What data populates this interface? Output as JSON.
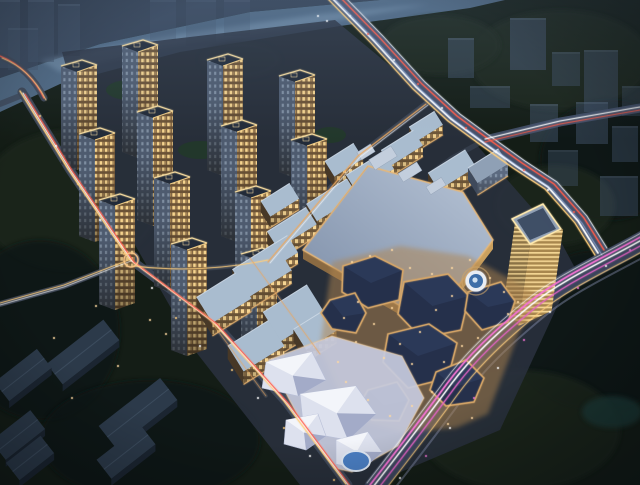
{
  "image": {
    "alt": "Aerial night rendering of a mixed-use development: lit residential towers by a river, a large flat-roofed shopping mall, a golden office tower, faceted commercial pavilions around a glowing plaza, a bright festival square with white tents and a blue pool, roads with coloured light trails and dark woodland around the site"
  },
  "palette": {
    "base": "#141d16",
    "farShore": "#36455a",
    "river": "#4e6781",
    "riverHi": "#7e9ab4",
    "treeA": "#1a271e",
    "treeB": "#0f1812",
    "treeC": "#223829",
    "pond": "#1d3b38",
    "ghost": "#42536a",
    "pad": "#2a3140",
    "asphalt": "#3d4758",
    "asphaltMain": "#475470",
    "asphaltCurve": "#3b455c",
    "trailWhite": "#ffffff",
    "trailWarm": "#ffcf7e",
    "trailRed": "#ff5d49",
    "trailMagenta": "#f273d2",
    "trailMagenta2": "#e263c4",
    "trailBlue": "#a8c4ff",
    "trailTail": "#8891b0",
    "towerRoof": "#222b39",
    "towerWarmBase": "#6b5236",
    "towerWin": "#f5d38e",
    "towerWin2": "#caa266",
    "towerCoolBase": "#4e5b6f",
    "towerCoolWin": "#aebfd2",
    "crown": "#ffe3a4",
    "mallLight": "#b7c4d6",
    "mallDark": "#7b8ca6",
    "mallEdge": "#e8b878",
    "mallFacade": "#caa05e",
    "mallFacadeDark": "#8a6a42",
    "mallBump": "#c3cedd",
    "midRoof": "#a9bccf",
    "midRoofEdge": "#cdd9e6",
    "midFacade": "#6e5638",
    "midWin": "#f6d592",
    "midSide": "#473827",
    "midCoolFacade": "#5c6a80",
    "goldFace1": "#a8874e",
    "goldFace2": "#8f7648",
    "goldLine": "#f2d492",
    "goldRoof": "#93a4ba",
    "goldEdge": "#ffe9ae",
    "pavRoof": "#25304b",
    "pavFacet": "#2e3c5c",
    "pavEdge": "#d9a868",
    "walkway": "#b08550",
    "dotWarm": "#ffd9a2",
    "slabRoof": "#2c3a4a",
    "slabSide": "#1b2531",
    "slabRidge": "#3c4c5e",
    "festGround": "#c6cade",
    "tent": "#dde1ee",
    "tentHi": "#f3f5fa",
    "tentShade": "#a3abc8",
    "pool": "#4a7ec2",
    "poolRim": "#dfe8f4",
    "fountainRing": "#e9edf3",
    "fountainWater": "#3e6ea8",
    "vignette": "rgba(2,6,12,0.42)"
  },
  "scene": {
    "river": [
      [
        0,
        78
      ],
      [
        100,
        44
      ],
      [
        250,
        12
      ],
      [
        380,
        0
      ],
      [
        505,
        0
      ],
      [
        470,
        8
      ],
      [
        340,
        26
      ],
      [
        180,
        52
      ],
      [
        60,
        84
      ],
      [
        0,
        112
      ]
    ],
    "riverHighlight": [
      [
        40,
        60
      ],
      [
        180,
        34
      ],
      [
        320,
        14
      ],
      [
        430,
        4
      ],
      [
        330,
        22
      ],
      [
        160,
        48
      ],
      [
        60,
        72
      ]
    ],
    "farShore": [
      [
        0,
        0
      ],
      [
        380,
        0
      ],
      [
        250,
        12
      ],
      [
        100,
        44
      ],
      [
        0,
        78
      ]
    ],
    "sitePad": [
      [
        62,
        52
      ],
      [
        335,
        20
      ],
      [
        455,
        120
      ],
      [
        560,
        240
      ],
      [
        575,
        268
      ],
      [
        500,
        430
      ],
      [
        370,
        485
      ],
      [
        300,
        485
      ],
      [
        196,
        352
      ],
      [
        98,
        180
      ]
    ],
    "treeBlobs": [
      [
        70,
        200,
        90,
        70,
        "treeA"
      ],
      [
        40,
        330,
        80,
        90,
        "treeB"
      ],
      [
        150,
        440,
        110,
        60,
        "treeB"
      ],
      [
        560,
        60,
        90,
        50,
        "treeA"
      ],
      [
        610,
        160,
        70,
        60,
        "treeB"
      ],
      [
        555,
        205,
        60,
        40,
        "treeA"
      ],
      [
        600,
        330,
        90,
        80,
        "treeB"
      ],
      [
        520,
        430,
        100,
        60,
        "treeA"
      ],
      [
        440,
        45,
        60,
        30,
        "treeA"
      ],
      [
        240,
        60,
        40,
        18,
        "treeA"
      ],
      [
        612,
        412,
        30,
        16,
        "pond"
      ]
    ],
    "greenPockets": [
      [
        130,
        90,
        24,
        10
      ],
      [
        200,
        150,
        22,
        9
      ],
      [
        260,
        220,
        20,
        8
      ],
      [
        330,
        135,
        16,
        8
      ],
      [
        300,
        170,
        12,
        6
      ],
      [
        255,
        230,
        12,
        6
      ]
    ],
    "ghostBuildings": [
      [
        448,
        38,
        26,
        40,
        0.5
      ],
      [
        510,
        18,
        36,
        52,
        0.55
      ],
      [
        552,
        52,
        28,
        34,
        0.45
      ],
      [
        584,
        50,
        34,
        62,
        0.5
      ],
      [
        470,
        86,
        40,
        22,
        0.45
      ],
      [
        530,
        104,
        28,
        38,
        0.5
      ],
      [
        576,
        102,
        32,
        42,
        0.5
      ],
      [
        612,
        126,
        26,
        36,
        0.45
      ],
      [
        548,
        150,
        30,
        36,
        0.4
      ],
      [
        600,
        176,
        38,
        40,
        0.45
      ],
      [
        622,
        86,
        18,
        30,
        0.4
      ],
      [
        28,
        0,
        26,
        62,
        0.5
      ],
      [
        58,
        4,
        22,
        52,
        0.45
      ],
      [
        0,
        0,
        20,
        68,
        0.55
      ],
      [
        8,
        28,
        30,
        42,
        0.35
      ],
      [
        150,
        0,
        26,
        40,
        0.3
      ],
      [
        186,
        0,
        30,
        46,
        0.28
      ],
      [
        224,
        0,
        26,
        36,
        0.26
      ]
    ],
    "towers": [
      [
        82,
        60,
        98
      ],
      [
        143,
        40,
        106
      ],
      [
        228,
        54,
        110
      ],
      [
        300,
        70,
        96
      ],
      [
        100,
        128,
        102
      ],
      [
        158,
        106,
        108
      ],
      [
        242,
        120,
        110
      ],
      [
        312,
        134,
        92
      ],
      [
        120,
        194,
        104
      ],
      [
        175,
        172,
        108
      ],
      [
        256,
        186,
        108
      ],
      [
        192,
        238,
        106
      ],
      [
        262,
        248,
        96
      ]
    ],
    "midrises": [
      [
        292,
        228,
        46,
        20,
        12,
        "w"
      ],
      [
        332,
        200,
        48,
        20,
        12,
        "w"
      ],
      [
        370,
        172,
        44,
        20,
        12,
        "w"
      ],
      [
        402,
        148,
        38,
        18,
        11,
        "w"
      ],
      [
        426,
        126,
        30,
        16,
        10,
        "w"
      ],
      [
        280,
        200,
        34,
        18,
        11,
        "w"
      ],
      [
        344,
        160,
        34,
        18,
        11,
        "w"
      ],
      [
        224,
        298,
        46,
        30,
        13,
        "w"
      ],
      [
        262,
        270,
        50,
        32,
        13,
        "w"
      ],
      [
        294,
        313,
        52,
        34,
        13,
        "w"
      ],
      [
        256,
        346,
        48,
        30,
        13,
        "w"
      ],
      [
        315,
        330,
        36,
        24,
        12,
        "w"
      ],
      [
        280,
        252,
        30,
        20,
        11,
        "w"
      ],
      [
        452,
        170,
        44,
        20,
        15,
        "w"
      ],
      [
        488,
        166,
        36,
        18,
        12,
        "c"
      ]
    ],
    "mall": {
      "roof": [
        [
          368,
          166
        ],
        [
          463,
          192
        ],
        [
          493,
          240
        ],
        [
          430,
          323
        ],
        [
          303,
          250
        ]
      ],
      "bumps": [
        [
          383,
          158,
          26,
          12
        ],
        [
          410,
          172,
          22,
          10
        ],
        [
          436,
          186,
          18,
          9
        ],
        [
          366,
          152,
          16,
          9
        ]
      ]
    },
    "goldTower": {
      "L": [
        512,
        219
      ],
      "T": [
        543,
        204
      ],
      "R": [
        561,
        229
      ],
      "B": [
        530,
        244
      ],
      "h": 82
    },
    "fountain": [
      476,
      281
    ],
    "walkway": [
      [
        332,
        262
      ],
      [
        400,
        246
      ],
      [
        468,
        256
      ],
      [
        516,
        282
      ],
      [
        540,
        298
      ],
      [
        520,
        330
      ],
      [
        488,
        414
      ],
      [
        456,
        428
      ],
      [
        402,
        432
      ],
      [
        350,
        418
      ],
      [
        320,
        348
      ]
    ],
    "pavilions": [
      [
        [
          343,
          266
        ],
        [
          375,
          256
        ],
        [
          403,
          270
        ],
        [
          399,
          300
        ],
        [
          368,
          308
        ],
        [
          342,
          292
        ]
      ],
      [
        [
          404,
          282
        ],
        [
          448,
          274
        ],
        [
          469,
          296
        ],
        [
          461,
          330
        ],
        [
          421,
          338
        ],
        [
          398,
          314
        ]
      ],
      [
        [
          468,
          292
        ],
        [
          501,
          282
        ],
        [
          515,
          301
        ],
        [
          508,
          322
        ],
        [
          482,
          330
        ],
        [
          465,
          311
        ]
      ],
      [
        [
          388,
          334
        ],
        [
          429,
          324
        ],
        [
          457,
          343
        ],
        [
          448,
          378
        ],
        [
          408,
          388
        ],
        [
          383,
          362
        ]
      ],
      [
        [
          330,
          300
        ],
        [
          355,
          293
        ],
        [
          366,
          313
        ],
        [
          356,
          333
        ],
        [
          332,
          329
        ],
        [
          321,
          313
        ]
      ],
      [
        [
          436,
          372
        ],
        [
          466,
          360
        ],
        [
          484,
          378
        ],
        [
          474,
          402
        ],
        [
          446,
          406
        ],
        [
          430,
          390
        ]
      ],
      [
        [
          368,
          390
        ],
        [
          397,
          382
        ],
        [
          409,
          400
        ],
        [
          399,
          421
        ],
        [
          372,
          420
        ],
        [
          359,
          405
        ]
      ]
    ],
    "festival": {
      "ground": [
        [
          268,
          360
        ],
        [
          332,
          336
        ],
        [
          402,
          356
        ],
        [
          424,
          398
        ],
        [
          398,
          446
        ],
        [
          352,
          472
        ],
        [
          334,
          468
        ],
        [
          298,
          416
        ]
      ],
      "tents": [
        [
          [
            266,
            362
          ],
          [
            312,
            352
          ],
          [
            326,
            380
          ],
          [
            298,
            396
          ],
          [
            262,
            388
          ]
        ],
        [
          [
            300,
            394
          ],
          [
            356,
            386
          ],
          [
            376,
            414
          ],
          [
            348,
            440
          ],
          [
            304,
            432
          ]
        ],
        [
          [
            286,
            420
          ],
          [
            318,
            414
          ],
          [
            326,
            436
          ],
          [
            306,
            450
          ],
          [
            284,
            444
          ]
        ],
        [
          [
            336,
            440
          ],
          [
            368,
            432
          ],
          [
            382,
            452
          ],
          [
            362,
            470
          ],
          [
            336,
            464
          ]
        ]
      ],
      "pool": [
        356,
        461,
        13,
        9
      ]
    },
    "darkSlabs": [
      [
        83,
        352,
        72,
        26
      ],
      [
        138,
        413,
        78,
        28
      ],
      [
        23,
        375,
        54,
        24
      ],
      [
        18,
        435,
        50,
        24
      ],
      [
        30,
        458,
        44,
        22
      ],
      [
        126,
        452,
        56,
        24
      ]
    ],
    "roads": {
      "left": "M22,92 L70,170 L131,260 L214,322 L286,402 L348,485",
      "rampA": "M0,56 C20,64 34,78 44,98",
      "rampB": "M0,104 L20,96",
      "branchW": "M131,260 L64,286 L0,304",
      "crossB": "M134,266 Q200,274 268,260",
      "service": "M268,262 L358,156 L426,104",
      "swA": "M250,258 L320,354",
      "swB": "M204,312 L266,396",
      "main": "M333,-6 L378,40 L420,86 L455,118 L485,140 L520,165 L552,186 L582,220 L602,252",
      "east": "M485,140 L560,122 L640,108",
      "spur": "M485,140 L452,158 L430,174",
      "curve": "M648,238 C606,262 564,280 532,306 C498,334 472,358 450,388 C428,418 402,452 374,488"
    },
    "lights": [
      [
        352,
        262,
        "a"
      ],
      [
        370,
        256,
        "a"
      ],
      [
        392,
        250,
        "a"
      ],
      [
        410,
        268,
        "a"
      ],
      [
        432,
        274,
        "a"
      ],
      [
        452,
        268,
        "a"
      ],
      [
        470,
        260,
        "a"
      ],
      [
        490,
        278,
        "a"
      ],
      [
        504,
        292,
        "a"
      ],
      [
        518,
        302,
        "a"
      ],
      [
        452,
        296,
        "a"
      ],
      [
        436,
        310,
        "a"
      ],
      [
        420,
        332,
        "a"
      ],
      [
        400,
        344,
        "a"
      ],
      [
        384,
        358,
        "a"
      ],
      [
        412,
        364,
        "a"
      ],
      [
        444,
        362,
        "a"
      ],
      [
        462,
        346,
        "a"
      ],
      [
        478,
        338,
        "a"
      ],
      [
        432,
        392,
        "a"
      ],
      [
        412,
        406,
        "a"
      ],
      [
        390,
        416,
        "a"
      ],
      [
        368,
        400,
        "a"
      ],
      [
        346,
        382,
        "a"
      ],
      [
        338,
        362,
        "a"
      ],
      [
        356,
        342,
        "a"
      ],
      [
        374,
        324,
        "a"
      ],
      [
        392,
        308,
        "a"
      ],
      [
        358,
        302,
        "a"
      ],
      [
        344,
        318,
        "a"
      ],
      [
        508,
        314,
        "a"
      ],
      [
        472,
        418,
        "a"
      ],
      [
        448,
        424,
        "a"
      ],
      [
        350,
        16,
        "w"
      ],
      [
        368,
        34,
        "r"
      ],
      [
        394,
        60,
        "w"
      ],
      [
        418,
        84,
        "r"
      ],
      [
        442,
        108,
        "w"
      ],
      [
        466,
        128,
        "r"
      ],
      [
        496,
        152,
        "w"
      ],
      [
        524,
        170,
        "r"
      ],
      [
        548,
        190,
        "w"
      ],
      [
        574,
        212,
        "r"
      ],
      [
        630,
        250,
        "m"
      ],
      [
        606,
        266,
        "w"
      ],
      [
        578,
        288,
        "m"
      ],
      [
        550,
        312,
        "w"
      ],
      [
        524,
        340,
        "m"
      ],
      [
        498,
        368,
        "w"
      ],
      [
        474,
        398,
        "m"
      ],
      [
        450,
        428,
        "w"
      ],
      [
        426,
        456,
        "m"
      ],
      [
        400,
        478,
        "w"
      ],
      [
        40,
        116,
        "o"
      ],
      [
        56,
        146,
        "w"
      ],
      [
        78,
        184,
        "o"
      ],
      [
        100,
        220,
        "w"
      ],
      [
        124,
        254,
        "o"
      ],
      [
        152,
        288,
        "w"
      ],
      [
        176,
        318,
        "o"
      ],
      [
        200,
        346,
        "w"
      ],
      [
        232,
        370,
        "o"
      ],
      [
        258,
        398,
        "w"
      ],
      [
        284,
        428,
        "o"
      ],
      [
        310,
        456,
        "w"
      ],
      [
        334,
        480,
        "o"
      ],
      [
        150,
        320,
        "a"
      ],
      [
        166,
        334,
        "a"
      ],
      [
        96,
        306,
        "a"
      ],
      [
        54,
        338,
        "a"
      ],
      [
        180,
        300,
        "a"
      ],
      [
        118,
        366,
        "a"
      ],
      [
        72,
        398,
        "a"
      ],
      [
        318,
        16,
        "w"
      ],
      [
        327,
        21,
        "w"
      ]
    ]
  }
}
